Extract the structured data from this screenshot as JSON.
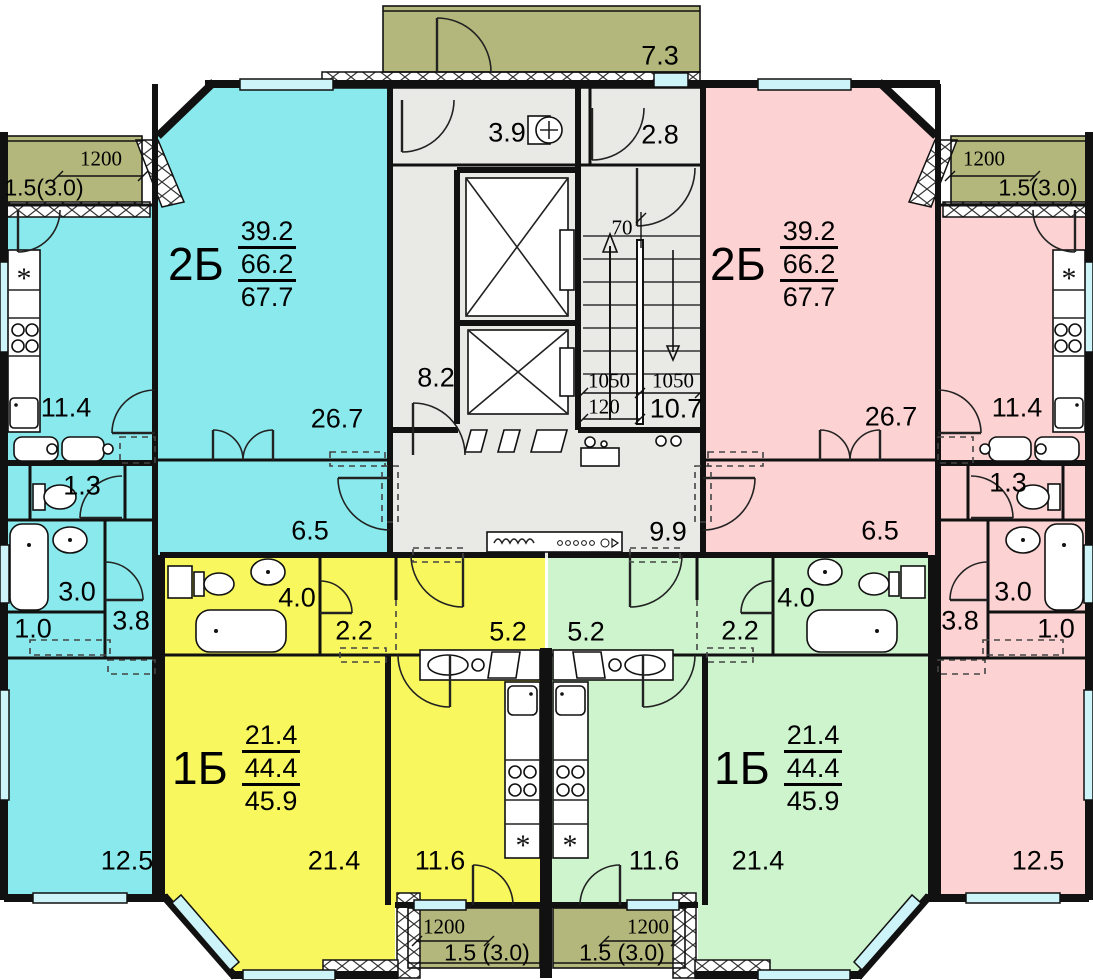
{
  "palette": {
    "cyan": "#8ae9ec",
    "pink": "#fcd2d2",
    "yellow": "#f8f85e",
    "green": "#cef4ce",
    "olive": "#b3b77b",
    "core_gray": "#e9e9e6",
    "window_glass": "#cdf4f8",
    "wall": "#111111"
  },
  "icons": {
    "fridge_symbol": "*"
  },
  "core": {
    "entrance_balcony_area": "7.3",
    "lobby_area": "3.9",
    "vestibule_area": "2.8",
    "elevator_hall_area": "8.2",
    "stair_area": "10.7",
    "corridor_area": "9.9",
    "dims": {
      "flight_left": "1050",
      "flight_right": "1050",
      "gap": "120",
      "step": "70"
    }
  },
  "apartments": {
    "left_2b": {
      "type_label": "2Б",
      "living_total": "39.2",
      "area_total": "66.2",
      "area_with_summer": "67.7",
      "rooms": {
        "living": "26.7",
        "kitchen": "11.4",
        "hall": "6.5",
        "wc": "1.3",
        "bathroom": "3.0",
        "corridor": "3.8",
        "storage": "1.0",
        "bedroom": "12.5"
      }
    },
    "right_2b": {
      "type_label": "2Б",
      "living_total": "39.2",
      "area_total": "66.2",
      "area_with_summer": "67.7",
      "rooms": {
        "living": "26.7",
        "kitchen": "11.4",
        "hall": "6.5",
        "wc": "1.3",
        "bathroom": "3.0",
        "corridor": "3.8",
        "storage": "1.0",
        "bedroom": "12.5"
      }
    },
    "left_1b": {
      "type_label": "1Б",
      "living_total": "21.4",
      "area_total": "44.4",
      "area_with_summer": "45.9",
      "rooms": {
        "living": "21.4",
        "kitchen": "11.6",
        "hall": "5.2",
        "corridor": "2.2",
        "bathroom": "4.0"
      }
    },
    "right_1b": {
      "type_label": "1Б",
      "living_total": "21.4",
      "area_total": "44.4",
      "area_with_summer": "45.9",
      "rooms": {
        "living": "21.4",
        "kitchen": "11.6",
        "hall": "5.2",
        "corridor": "2.2",
        "bathroom": "4.0"
      }
    }
  },
  "balconies": {
    "top_center": {
      "area": "7.3"
    },
    "top_left": {
      "width_dim": "1200",
      "area": "1.5(3.0)"
    },
    "top_right": {
      "width_dim": "1200",
      "area": "1.5(3.0)"
    },
    "bottom_left": {
      "width_dim": "1200",
      "area": "1.5 (3.0)"
    },
    "bottom_right": {
      "width_dim": "1200",
      "area": "1.5 (3.0)"
    }
  }
}
